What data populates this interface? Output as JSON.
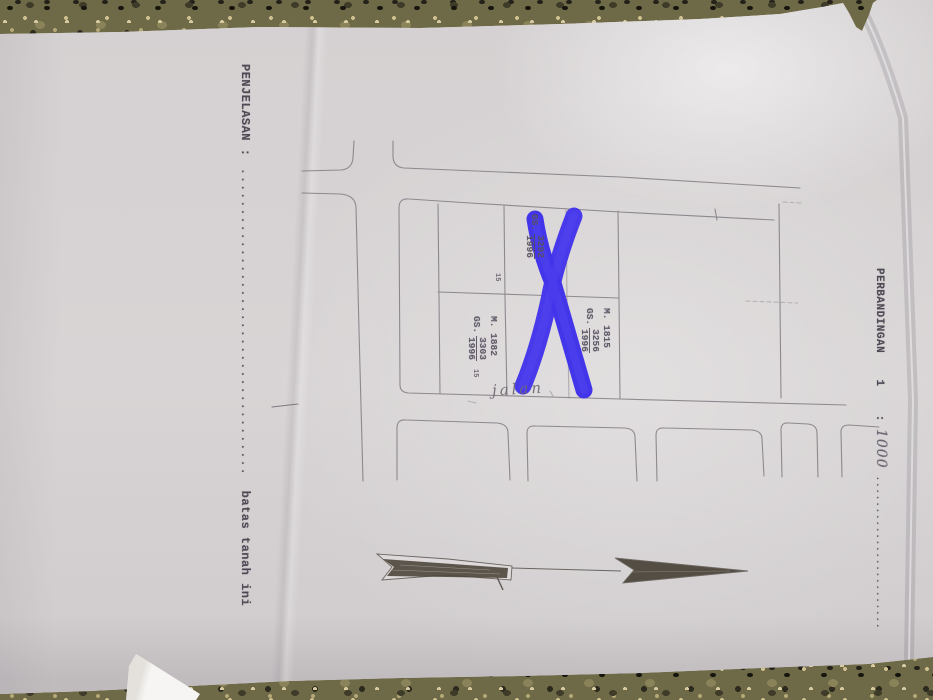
{
  "scene": {
    "description": "photo of an Indonesian land-survey sketch page lying on a granite countertop",
    "colors": {
      "granite": "#6e6947",
      "paper": "#d7d3d4",
      "ink": "#4e4954",
      "marker_blue": "#4335ea",
      "arrow_fill": "#4d463c"
    }
  },
  "document": {
    "penjelasan": {
      "label": "PENJELASAN",
      "colon": ":",
      "dots": "......................................",
      "note": "batas tanah ini"
    },
    "perbandingan": {
      "label": "PERBANDINGAN",
      "number": "1",
      "colon": ":",
      "scale_value": "1000",
      "dots": "........................"
    },
    "map": {
      "road_label": "jalan",
      "parcels": [
        {
          "gs_prefix": "GS.",
          "gs_number": "3292",
          "year": "1996"
        },
        {
          "m": "M. 1815",
          "gs_prefix": "GS.",
          "gs_number": "3256",
          "year": "1996"
        },
        {
          "m": "M. 1882",
          "gs_prefix": "GS.",
          "gs_number": "3303",
          "year": "1996"
        }
      ],
      "markers": [
        "15",
        "15"
      ]
    },
    "annotation": {
      "type": "X",
      "color": "#4335ea"
    }
  }
}
